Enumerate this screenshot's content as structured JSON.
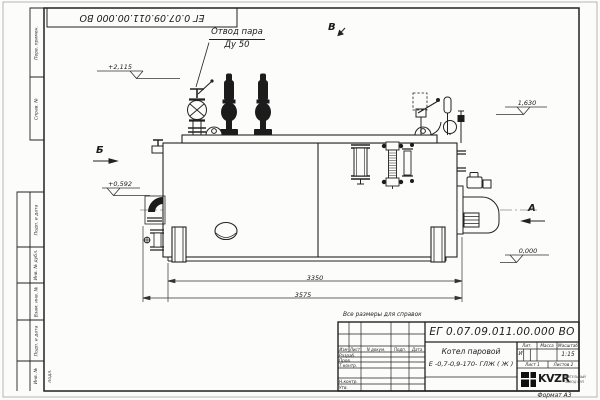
{
  "sheet": {
    "designation_top": "ЕГ 0.07.09.011.00.000  ВО",
    "reference_note": "Все размеры для справок",
    "format_label": "Формат А3"
  },
  "margin": {
    "perv_primen": "Перв. примен.",
    "sprav_no": "Справ. №",
    "podp_data_1": "Подп. и дата",
    "inv_dubl": "Инв. № дубл.",
    "vzam_inv": "Взам. инв. №",
    "podp_data_2": "Подп. и дата",
    "inv_podl": "Инв. № подл."
  },
  "drawing": {
    "steam_outlet_label_1": "Отвод пара",
    "steam_outlet_label_2": "Ду 50",
    "view_top": "В",
    "view_left": "Б",
    "view_right": "А",
    "elev_top": "+2,115",
    "elev_left": "+0,592",
    "elev_right": "1,630",
    "elev_zero": "0,000",
    "dim_inner": "3350",
    "dim_outer": "3575"
  },
  "title_block": {
    "designation": "ЕГ 0.07.09.011.00.000  ВО",
    "name_line_1": "Котел паровой",
    "name_line_2": "Е -0,7-0,9-170- ГЛЖ ( Ж )",
    "col_izm": "Изм",
    "col_list": "Лист",
    "col_doc": "N докум.",
    "col_podp": "Подп.",
    "col_data": "Дата",
    "row_razrab": "Разраб.",
    "row_prov": "Пров.",
    "row_tkontr": "Т.контр.",
    "row_nkontr": "Н.контр.",
    "row_utv": "Утв.",
    "lit_header": "Лит.",
    "massa_header": "Масса",
    "masshtab_header": "Масштаб",
    "lit_value": "И",
    "scale_value": "1:15",
    "list_label": "Лист",
    "list_value": "1",
    "listov_label": "Листов",
    "listov_value": "2",
    "logo_text": "KVZR",
    "logo_sub_1": "КОТЕЛЬНЫЙ",
    "logo_sub_2": "ЗАВОД РЭП"
  }
}
